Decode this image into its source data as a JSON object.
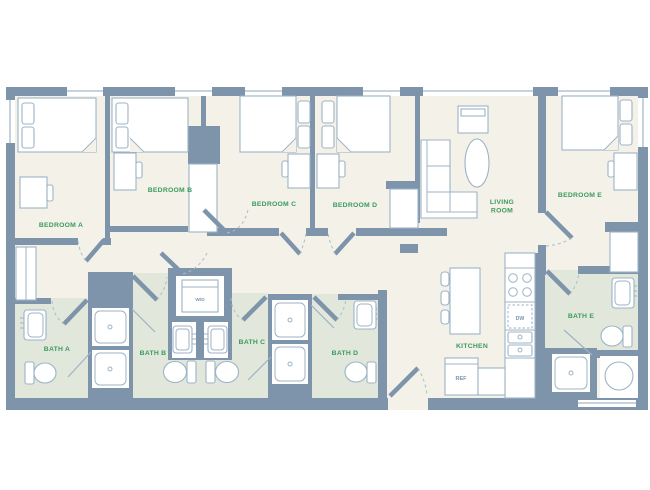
{
  "floor_plan": {
    "colors": {
      "wall": "#7D94AB",
      "floor": "#F4F1E9",
      "bathroom_floor": "#E2E7DB",
      "fixture_outline": "#9CB3C6",
      "room_label_green": "#3A9B5C",
      "background": "#FFFFFF"
    },
    "bedrooms": [
      {
        "label": "BEDROOM A"
      },
      {
        "label": "BEDROOM B"
      },
      {
        "label": "BEDROOM C"
      },
      {
        "label": "BEDROOM D"
      },
      {
        "label": "BEDROOM E"
      }
    ],
    "baths": [
      {
        "label": "BATH A"
      },
      {
        "label": "BATH B"
      },
      {
        "label": "BATH C"
      },
      {
        "label": "BATH D"
      },
      {
        "label": "BATH E"
      }
    ],
    "living_room": {
      "label_line_1": "LIVING",
      "label_line_2": "ROOM"
    },
    "kitchen": {
      "label": "KITCHEN",
      "refrigerator_label": "REF",
      "dishwasher_label": "DW"
    },
    "laundry": {
      "washer_dryer_label": "W/D"
    }
  }
}
